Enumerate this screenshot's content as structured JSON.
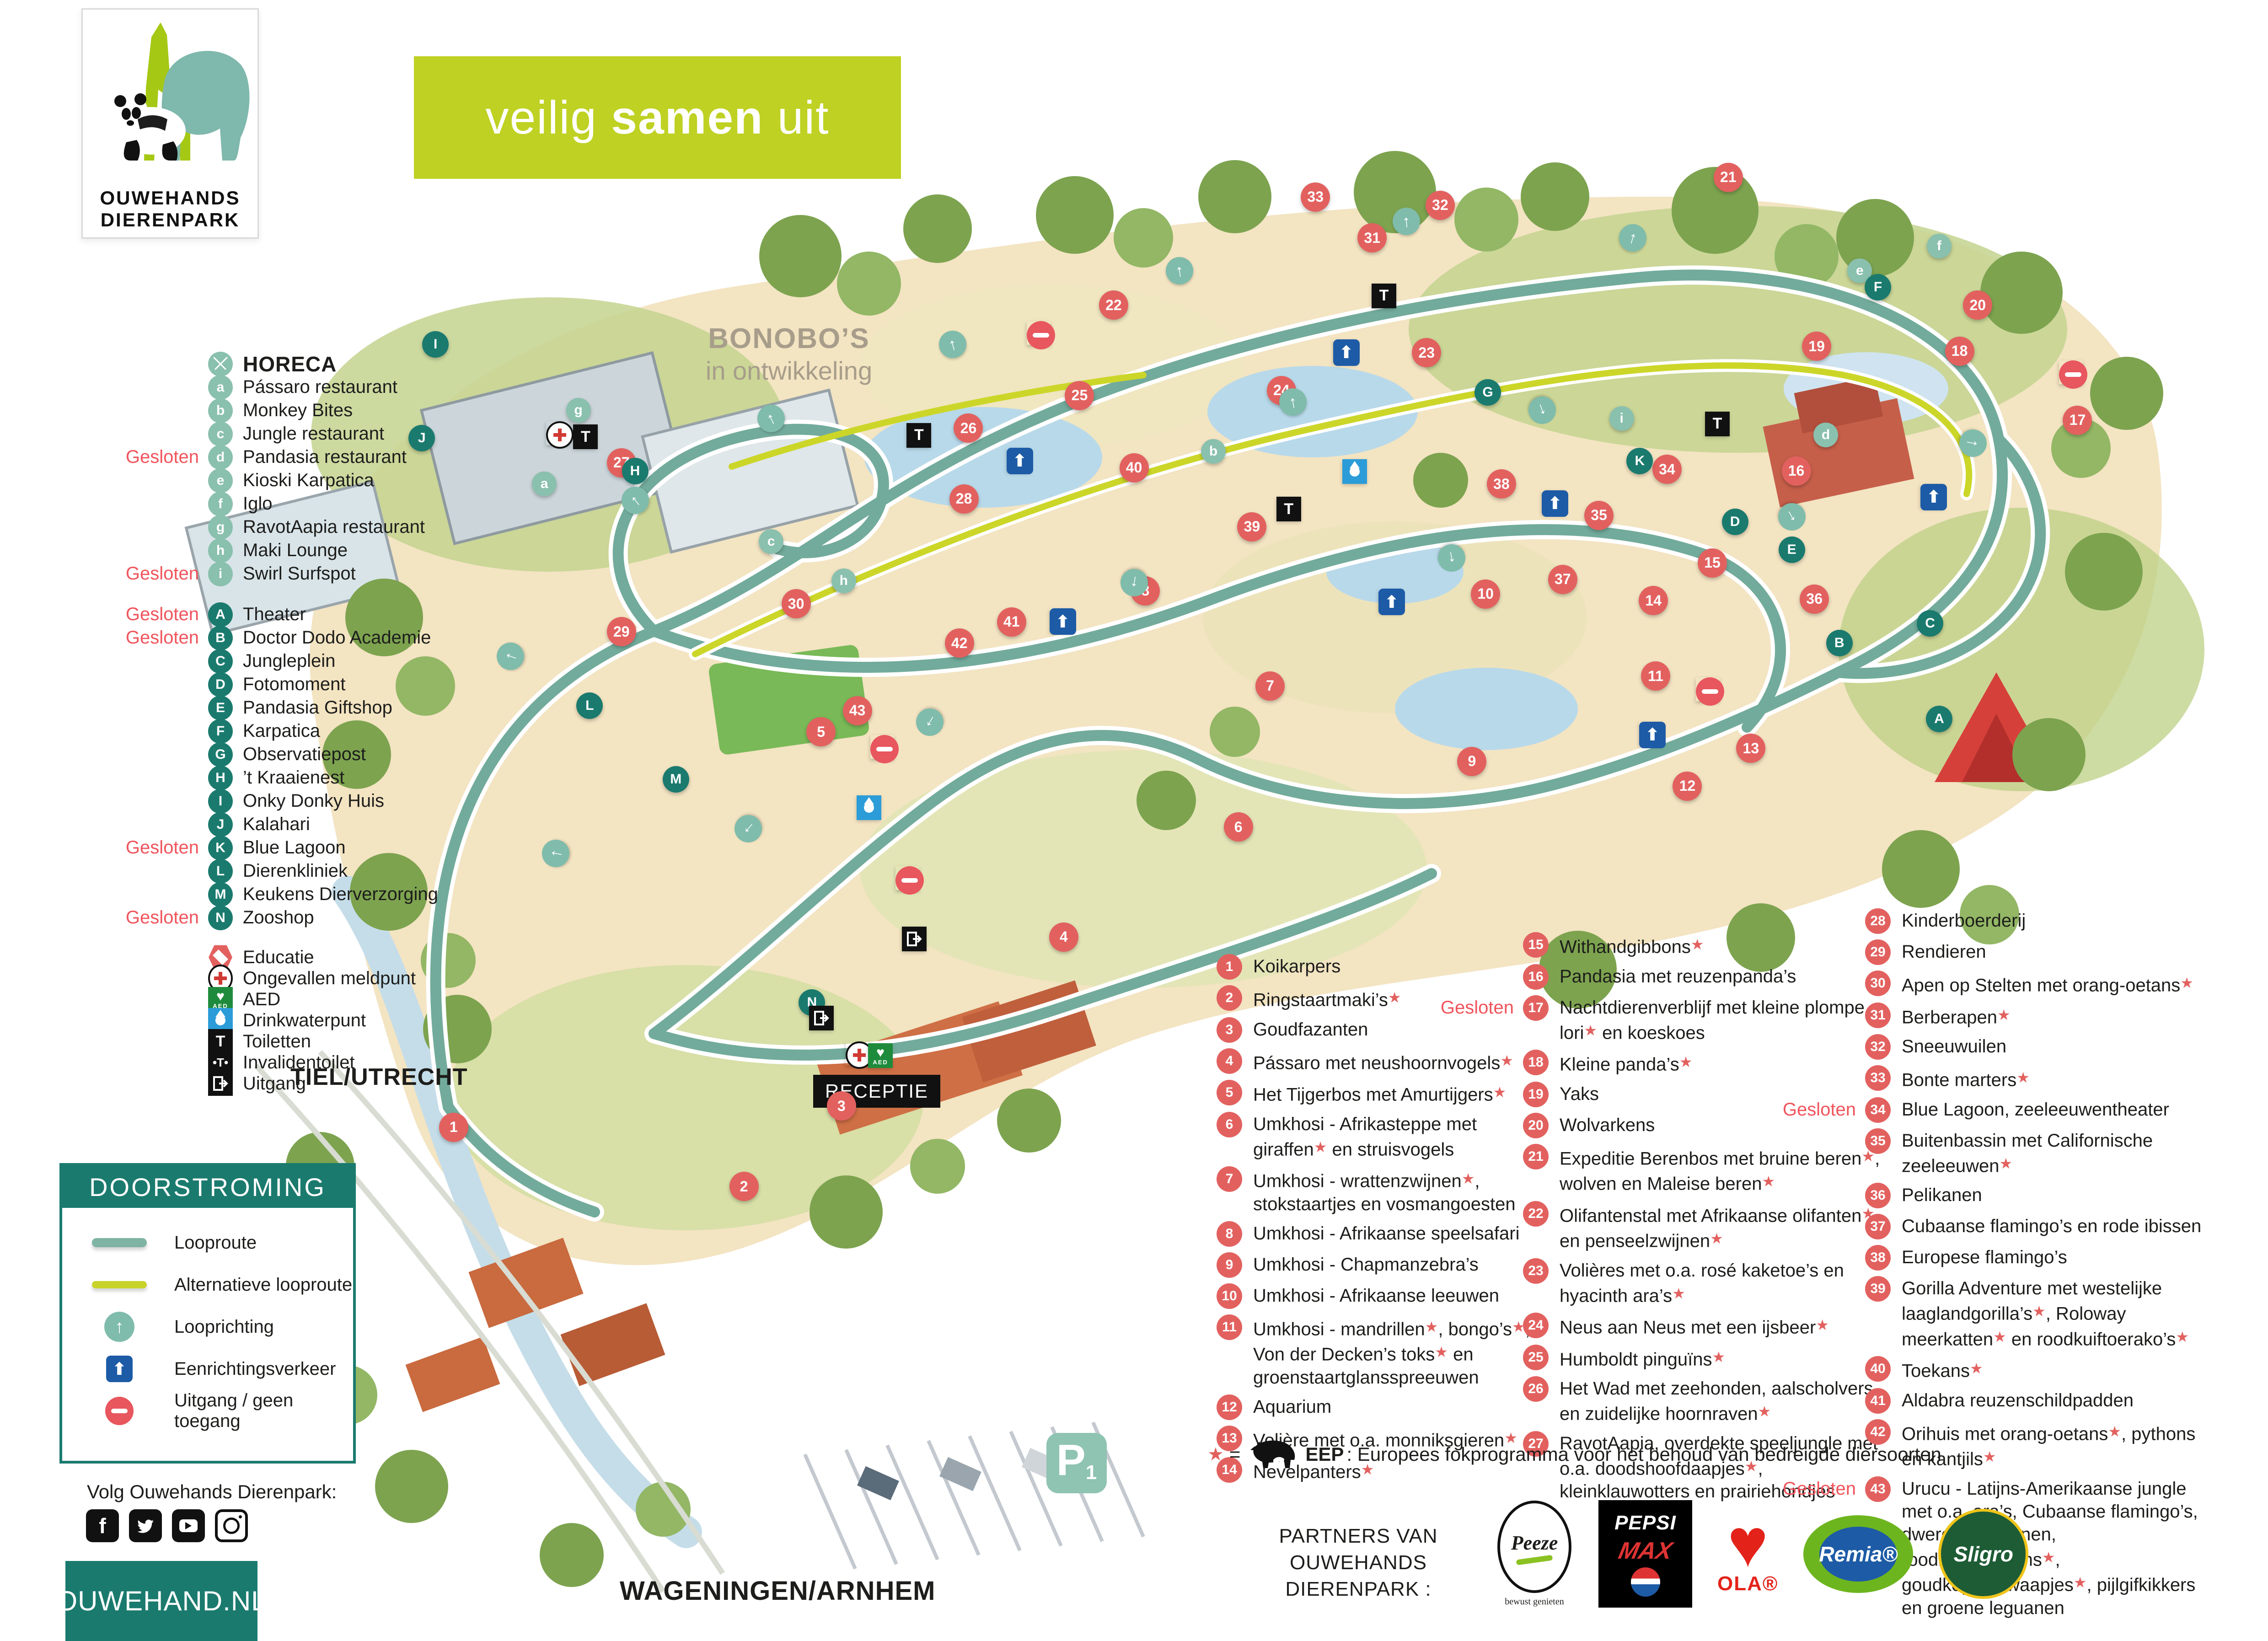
{
  "logo": {
    "line1": "OUWEHANDS",
    "line2": "DIERENPARK"
  },
  "banner": {
    "pre": "veilig ",
    "bold": "samen",
    "post": " uit"
  },
  "colors": {
    "teal_dark": "#1b7a6e",
    "teal_light": "#8ac0ae",
    "salmon": "#e2615f",
    "gesloten": "#f0545c",
    "banner_green": "#bfd122",
    "oneway_blue": "#1d5ba6"
  },
  "legend_horeca": {
    "title": "HORECA",
    "icon": "fork-knife-icon",
    "items": [
      {
        "id": "a",
        "label": "Pássaro restaurant",
        "closed": false
      },
      {
        "id": "b",
        "label": "Monkey Bites",
        "closed": false
      },
      {
        "id": "c",
        "label": "Jungle restaurant",
        "closed": false
      },
      {
        "id": "d",
        "label": "Pandasia restaurant",
        "closed": true
      },
      {
        "id": "e",
        "label": "Kioski Karpatica",
        "closed": false
      },
      {
        "id": "f",
        "label": "Iglo",
        "closed": false
      },
      {
        "id": "g",
        "label": "RavotAapia restaurant",
        "closed": false
      },
      {
        "id": "h",
        "label": "Maki Lounge",
        "closed": false
      },
      {
        "id": "i",
        "label": "Swirl Surfspot",
        "closed": true
      }
    ]
  },
  "legend_letters": {
    "items": [
      {
        "id": "A",
        "label": "Theater",
        "closed": true
      },
      {
        "id": "B",
        "label": "Doctor Dodo Academie",
        "closed": true
      },
      {
        "id": "C",
        "label": "Jungleplein",
        "closed": false
      },
      {
        "id": "D",
        "label": "Fotomoment",
        "closed": false
      },
      {
        "id": "E",
        "label": "Pandasia Giftshop",
        "closed": false
      },
      {
        "id": "F",
        "label": "Karpatica",
        "closed": false
      },
      {
        "id": "G",
        "label": "Observatiepost",
        "closed": false
      },
      {
        "id": "H",
        "label": "’t Kraaienest",
        "closed": false
      },
      {
        "id": "I",
        "label": "Onky Donky Huis",
        "closed": false
      },
      {
        "id": "J",
        "label": "Kalahari",
        "closed": false
      },
      {
        "id": "K",
        "label": "Blue Lagoon",
        "closed": true
      },
      {
        "id": "L",
        "label": "Dierenkliniek",
        "closed": false
      },
      {
        "id": "M",
        "label": "Keukens Dierverzorging",
        "closed": false
      },
      {
        "id": "N",
        "label": "Zooshop",
        "closed": true
      }
    ]
  },
  "legend_facilities": {
    "items": [
      {
        "icon": "educatie",
        "label": "Educatie"
      },
      {
        "icon": "firstaid",
        "label": "Ongevallen meldpunt"
      },
      {
        "icon": "aed",
        "label": "AED"
      },
      {
        "icon": "water",
        "label": "Drinkwaterpunt"
      },
      {
        "icon": "toilet",
        "label": "Toiletten"
      },
      {
        "icon": "toilet-disabled",
        "label": "Invalidentoilet"
      },
      {
        "icon": "exit",
        "label": "Uitgang"
      }
    ]
  },
  "doorstroming": {
    "title": "DOORSTROMING",
    "items": [
      {
        "icon": "looproute",
        "label": "Looproute"
      },
      {
        "icon": "alt-looproute",
        "label": "Alternatieve looproute"
      },
      {
        "icon": "looprichting",
        "label": "Looprichting"
      },
      {
        "icon": "oneway",
        "label": "Eenrichtingsverkeer"
      },
      {
        "icon": "noentry",
        "label": "Uitgang / geen toegang"
      }
    ]
  },
  "social": {
    "heading": "Volg Ouwehands Dierenpark:",
    "icons": [
      "facebook",
      "twitter",
      "youtube",
      "instagram"
    ]
  },
  "website": "OUWEHAND.NL",
  "enclosures": {
    "col1": [
      {
        "n": 1,
        "label": "Koikarpers",
        "closed": false
      },
      {
        "n": 2,
        "label": "Ringstaartmaki’s★",
        "closed": false
      },
      {
        "n": 3,
        "label": "Goudfazanten",
        "closed": false
      },
      {
        "n": 4,
        "label": "Pássaro met neushoornvogels★",
        "closed": false
      },
      {
        "n": 5,
        "label": "Het Tijgerbos met Amurtijgers★",
        "closed": false
      },
      {
        "n": 6,
        "label": "Umkhosi - Afrikasteppe met giraffen★ en struisvogels",
        "closed": false
      },
      {
        "n": 7,
        "label": "Umkhosi - wrattenzwijnen★, stokstaartjes en vosmangoesten",
        "closed": false
      },
      {
        "n": 8,
        "label": "Umkhosi - Afrikaanse speelsafari",
        "closed": false
      },
      {
        "n": 9,
        "label": "Umkhosi - Chapmanzebra’s",
        "closed": false
      },
      {
        "n": 10,
        "label": "Umkhosi - Afrikaanse leeuwen",
        "closed": false
      },
      {
        "n": 11,
        "label": "Umkhosi - mandrillen★, bongo’s★, Von der Decken’s toks★ en groenstaartglansspreeuwen",
        "closed": false
      },
      {
        "n": 12,
        "label": "Aquarium",
        "closed": false
      },
      {
        "n": 13,
        "label": "Volière met o.a. monniksgieren★",
        "closed": false
      },
      {
        "n": 14,
        "label": "Nevelpanters★",
        "closed": false
      }
    ],
    "col2": [
      {
        "n": 15,
        "label": "Withandgibbons★",
        "closed": false
      },
      {
        "n": 16,
        "label": "Pandasia met reuzenpanda’s",
        "closed": false
      },
      {
        "n": 17,
        "label": "Nachtdierenverblijf met kleine plompe lori★ en koeskoes",
        "closed": true
      },
      {
        "n": 18,
        "label": "Kleine panda’s★",
        "closed": false
      },
      {
        "n": 19,
        "label": "Yaks",
        "closed": false
      },
      {
        "n": 20,
        "label": "Wolvarkens",
        "closed": false
      },
      {
        "n": 21,
        "label": "Expeditie Berenbos met bruine beren★, wolven en Maleise beren★",
        "closed": false
      },
      {
        "n": 22,
        "label": "Olifantenstal met Afrikaanse olifanten★ en penseelzwijnen★",
        "closed": false
      },
      {
        "n": 23,
        "label": "Volières met o.a. rosé kaketoe’s en hyacinth ara’s★",
        "closed": false
      },
      {
        "n": 24,
        "label": "Neus aan Neus met een ijsbeer★",
        "closed": false
      },
      {
        "n": 25,
        "label": "Humboldt pinguïns★",
        "closed": false
      },
      {
        "n": 26,
        "label": "Het Wad met zeehonden, aalscholvers en zuidelijke hoornraven★",
        "closed": false
      },
      {
        "n": 27,
        "label": "RavotAapia, overdekte speeljungle met o.a. doodshoofdaapjes★, kleinklauwotters en prairiehondjes",
        "closed": false
      }
    ],
    "col3": [
      {
        "n": 28,
        "label": "Kinderboerderij",
        "closed": false
      },
      {
        "n": 29,
        "label": "Rendieren",
        "closed": false
      },
      {
        "n": 30,
        "label": "Apen op Stelten met orang-oetans★",
        "closed": false
      },
      {
        "n": 31,
        "label": "Berberapen★",
        "closed": false
      },
      {
        "n": 32,
        "label": "Sneeuwuilen",
        "closed": false
      },
      {
        "n": 33,
        "label": "Bonte marters★",
        "closed": false
      },
      {
        "n": 34,
        "label": "Blue Lagoon, zeeleeuwentheater",
        "closed": true
      },
      {
        "n": 35,
        "label": "Buitenbassin met Californische zeeleeuwen★",
        "closed": false
      },
      {
        "n": 36,
        "label": "Pelikanen",
        "closed": false
      },
      {
        "n": 37,
        "label": "Cubaanse flamingo’s en rode ibissen",
        "closed": false
      },
      {
        "n": 38,
        "label": "Europese flamingo’s",
        "closed": false
      },
      {
        "n": 39,
        "label": "Gorilla Adventure met westelijke laaglandgorilla’s★, Roloway meerkatten★ en roodkuiftoerako’s★",
        "closed": false
      },
      {
        "n": 40,
        "label": "Toekans★",
        "closed": false
      },
      {
        "n": 41,
        "label": "Aldabra reuzenschildpadden",
        "closed": false
      },
      {
        "n": 42,
        "label": "Orihuis met orang-oetans★, pythons en kantjils★",
        "closed": false
      },
      {
        "n": 43,
        "label": "Urucu - Latijns-Amerikaanse jungle met o.a. ara’s, Cubaanse flamingo’s, dwergkaaimannen, roodbuiktamarins★, goudkopleeuwaapjes★, pijlgifkikkers en groene leguanen",
        "closed": true
      }
    ]
  },
  "gesloten_label": "Gesloten",
  "eep_note": {
    "star": "★",
    "eq": "=",
    "rhino_icon": "rhino-icon",
    "bold": "EEP",
    "text": ": Europees fokprogramma voor het behoud van bedreigde diersoorten"
  },
  "partners": {
    "heading_line1": "PARTNERS VAN",
    "heading_line2": "OUWEHANDS DIERENPARK :",
    "peeze": {
      "name": "Peeze",
      "sub": "bewust genieten"
    },
    "pepsi": {
      "line1": "PEPSI",
      "line2": "MAX"
    },
    "ola": {
      "name": "OLA®"
    },
    "remia": {
      "name": "Remia®"
    },
    "sligro": {
      "name": "Sligro"
    }
  },
  "map": {
    "labels": {
      "bonobo_title": "BONOBO’S",
      "bonobo_sub": "in ontwikkeling",
      "receptie": "RECEPTIE",
      "road_left": "TIEL/UTRECHT",
      "road_bottom": "WAGENINGEN/ARNHEM",
      "parking_p": "P",
      "parking_n": "1"
    },
    "markers": {
      "numbers": [
        {
          "n": 1,
          "x": 20.0,
          "y": 68.7
        },
        {
          "n": 2,
          "x": 32.8,
          "y": 72.3
        },
        {
          "n": 3,
          "x": 37.1,
          "y": 67.4
        },
        {
          "n": 4,
          "x": 46.9,
          "y": 57.1
        },
        {
          "n": 5,
          "x": 36.2,
          "y": 44.6
        },
        {
          "n": 6,
          "x": 54.6,
          "y": 50.4
        },
        {
          "n": 7,
          "x": 56.0,
          "y": 41.8
        },
        {
          "n": 8,
          "x": 50.5,
          "y": 36.0
        },
        {
          "n": 9,
          "x": 64.9,
          "y": 46.4
        },
        {
          "n": 10,
          "x": 65.5,
          "y": 36.2
        },
        {
          "n": 11,
          "x": 73.0,
          "y": 41.2
        },
        {
          "n": 12,
          "x": 74.4,
          "y": 47.9
        },
        {
          "n": 13,
          "x": 77.2,
          "y": 45.6
        },
        {
          "n": 14,
          "x": 72.9,
          "y": 36.6
        },
        {
          "n": 15,
          "x": 75.5,
          "y": 34.3
        },
        {
          "n": 16,
          "x": 79.2,
          "y": 28.7
        },
        {
          "n": 17,
          "x": 91.6,
          "y": 25.6
        },
        {
          "n": 18,
          "x": 86.4,
          "y": 21.4
        },
        {
          "n": 19,
          "x": 80.1,
          "y": 21.1
        },
        {
          "n": 20,
          "x": 87.2,
          "y": 18.6
        },
        {
          "n": 21,
          "x": 76.2,
          "y": 10.8
        },
        {
          "n": 22,
          "x": 49.1,
          "y": 18.6
        },
        {
          "n": 23,
          "x": 62.9,
          "y": 21.5
        },
        {
          "n": 24,
          "x": 56.5,
          "y": 23.8
        },
        {
          "n": 25,
          "x": 47.6,
          "y": 24.1
        },
        {
          "n": 26,
          "x": 42.7,
          "y": 26.1
        },
        {
          "n": 27,
          "x": 27.4,
          "y": 28.2
        },
        {
          "n": 28,
          "x": 42.5,
          "y": 30.4
        },
        {
          "n": 29,
          "x": 27.4,
          "y": 38.5
        },
        {
          "n": 30,
          "x": 35.1,
          "y": 36.8
        },
        {
          "n": 31,
          "x": 60.5,
          "y": 14.5
        },
        {
          "n": 32,
          "x": 63.5,
          "y": 12.5
        },
        {
          "n": 33,
          "x": 58.0,
          "y": 12.0
        },
        {
          "n": 34,
          "x": 73.5,
          "y": 28.6
        },
        {
          "n": 35,
          "x": 70.5,
          "y": 31.4
        },
        {
          "n": 36,
          "x": 80.0,
          "y": 36.5
        },
        {
          "n": 37,
          "x": 68.9,
          "y": 35.3
        },
        {
          "n": 38,
          "x": 66.2,
          "y": 29.5
        },
        {
          "n": 39,
          "x": 55.2,
          "y": 32.1
        },
        {
          "n": 40,
          "x": 50.0,
          "y": 28.5
        },
        {
          "n": 41,
          "x": 44.6,
          "y": 37.9
        },
        {
          "n": 42,
          "x": 42.3,
          "y": 39.2
        },
        {
          "n": 43,
          "x": 37.8,
          "y": 43.3
        }
      ],
      "letters_light": [
        {
          "id": "a",
          "x": 24.0,
          "y": 29.5
        },
        {
          "id": "b",
          "x": 53.5,
          "y": 27.5
        },
        {
          "id": "c",
          "x": 34.0,
          "y": 33.0
        },
        {
          "id": "d",
          "x": 80.5,
          "y": 26.5
        },
        {
          "id": "e",
          "x": 82.0,
          "y": 16.5
        },
        {
          "id": "f",
          "x": 85.5,
          "y": 15.0
        },
        {
          "id": "g",
          "x": 25.5,
          "y": 25.0
        },
        {
          "id": "h",
          "x": 37.2,
          "y": 35.4
        },
        {
          "id": "i",
          "x": 71.5,
          "y": 25.5
        }
      ],
      "letters_dark": [
        {
          "id": "A",
          "x": 85.5,
          "y": 43.8
        },
        {
          "id": "B",
          "x": 81.1,
          "y": 39.2
        },
        {
          "id": "C",
          "x": 85.1,
          "y": 38.0
        },
        {
          "id": "D",
          "x": 76.5,
          "y": 31.8
        },
        {
          "id": "E",
          "x": 79.0,
          "y": 33.5
        },
        {
          "id": "F",
          "x": 82.8,
          "y": 17.5
        },
        {
          "id": "G",
          "x": 65.6,
          "y": 23.9
        },
        {
          "id": "H",
          "x": 28.0,
          "y": 28.7
        },
        {
          "id": "I",
          "x": 19.2,
          "y": 21.0
        },
        {
          "id": "J",
          "x": 18.6,
          "y": 26.7
        },
        {
          "id": "K",
          "x": 72.3,
          "y": 28.1
        },
        {
          "id": "L",
          "x": 26.0,
          "y": 43.0
        },
        {
          "id": "M",
          "x": 29.8,
          "y": 47.5
        },
        {
          "id": "N",
          "x": 35.8,
          "y": 61.1
        }
      ],
      "facilities": [
        {
          "t": "toilet",
          "x": 25.8,
          "y": 26.6
        },
        {
          "t": "toilet",
          "x": 40.5,
          "y": 26.5
        },
        {
          "t": "toilet",
          "x": 56.8,
          "y": 31.0
        },
        {
          "t": "toilet",
          "x": 75.7,
          "y": 25.8
        },
        {
          "t": "toilet",
          "x": 61.0,
          "y": 18.0
        },
        {
          "t": "firstaid",
          "x": 24.6,
          "y": 26.4
        },
        {
          "t": "firstaid",
          "x": 37.8,
          "y": 64.2
        },
        {
          "t": "aed",
          "x": 38.8,
          "y": 64.3
        },
        {
          "t": "water",
          "x": 38.3,
          "y": 49.2
        },
        {
          "t": "water",
          "x": 59.7,
          "y": 28.7
        },
        {
          "t": "oneway",
          "x": 59.3,
          "y": 21.4
        },
        {
          "t": "oneway",
          "x": 68.5,
          "y": 30.6
        },
        {
          "t": "oneway",
          "x": 61.3,
          "y": 36.6
        },
        {
          "t": "oneway",
          "x": 46.8,
          "y": 37.8
        },
        {
          "t": "oneway",
          "x": 44.9,
          "y": 28.0
        },
        {
          "t": "oneway",
          "x": 85.2,
          "y": 30.2
        },
        {
          "t": "oneway",
          "x": 72.8,
          "y": 44.7
        },
        {
          "t": "noentry",
          "x": 45.8,
          "y": 20.3
        },
        {
          "t": "noentry",
          "x": 75.3,
          "y": 42.0
        },
        {
          "t": "noentry",
          "x": 91.3,
          "y": 22.7
        },
        {
          "t": "noentry",
          "x": 38.9,
          "y": 45.5
        },
        {
          "t": "noentry",
          "x": 40.0,
          "y": 53.5
        },
        {
          "t": "exit",
          "x": 40.3,
          "y": 57.2
        },
        {
          "t": "exit",
          "x": 36.2,
          "y": 62.0
        }
      ],
      "directions": [
        {
          "x": 24.5,
          "y": 52.0,
          "r": -80
        },
        {
          "x": 22.5,
          "y": 40.0,
          "r": -70
        },
        {
          "x": 28.0,
          "y": 30.5,
          "r": -40
        },
        {
          "x": 34.0,
          "y": 25.5,
          "r": -25
        },
        {
          "x": 42.0,
          "y": 21.0,
          "r": -15
        },
        {
          "x": 52.0,
          "y": 16.5,
          "r": -8
        },
        {
          "x": 62.0,
          "y": 13.5,
          "r": -5
        },
        {
          "x": 72.0,
          "y": 14.5,
          "r": 15
        },
        {
          "x": 87.0,
          "y": 27.0,
          "r": 100
        },
        {
          "x": 79.0,
          "y": 31.5,
          "r": 150
        },
        {
          "x": 64.0,
          "y": 34.0,
          "r": 170
        },
        {
          "x": 50.0,
          "y": 35.5,
          "r": 190
        },
        {
          "x": 41.0,
          "y": 44.0,
          "r": 210
        },
        {
          "x": 33.0,
          "y": 50.5,
          "r": 220
        },
        {
          "x": 57.0,
          "y": 24.5,
          "r": -10
        },
        {
          "x": 68.0,
          "y": 25.0,
          "r": 160
        }
      ]
    }
  }
}
